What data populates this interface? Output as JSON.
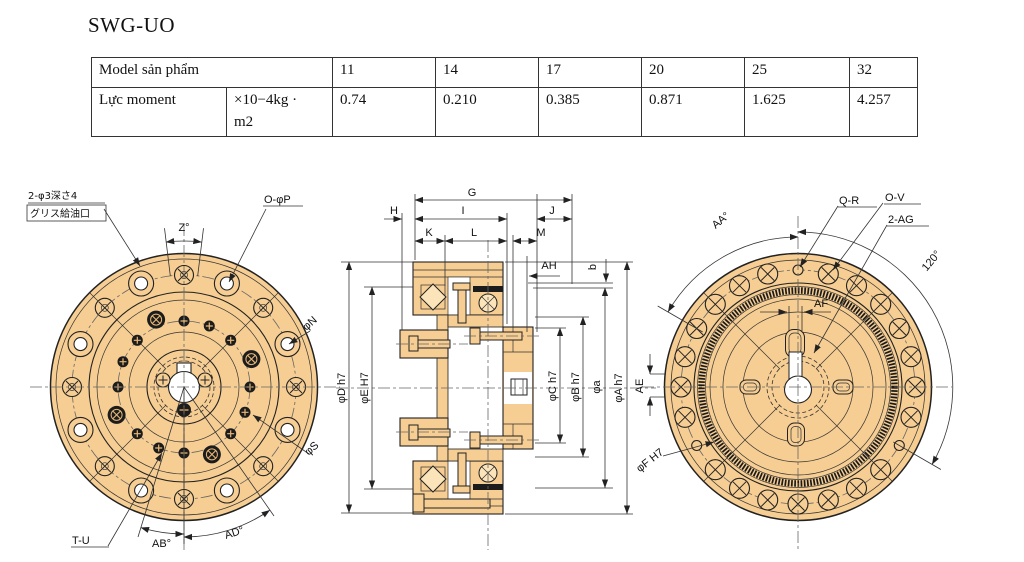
{
  "page": {
    "title": "SWG-UO"
  },
  "table": {
    "header_label": "Model sản phẩm",
    "models": [
      "11",
      "14",
      "17",
      "20",
      "25",
      "32"
    ],
    "row_label": "Lực moment",
    "unit_line1": "×10−4kg ·",
    "unit_line2": "m2",
    "values": [
      "0.74",
      "0.210",
      "0.385",
      "0.871",
      "1.625",
      "4.257"
    ]
  },
  "drawings": {
    "front_view": {
      "grease_note_line1": "2-φ3深さ4",
      "grease_note_line2": "グリス給油口",
      "bolt_label": "O-φP",
      "angle_z": "Z°",
      "dia_n": "φN",
      "dia_s": "φS",
      "screw_label": "T-U",
      "angle_ab": "AB°",
      "angle_ad": "AD°"
    },
    "section_view": {
      "dim_g": "G",
      "dim_h": "H",
      "dim_i": "I",
      "dim_j": "J",
      "dim_k": "K",
      "dim_l": "L",
      "dim_m": "M",
      "dim_ah": "AH",
      "dim_b": "b",
      "dia_d": "φD h7",
      "dia_e": "φE H7",
      "dia_c": "φC h7",
      "dia_b2": "φB h7",
      "dia_a_small": "φa",
      "dia_a": "φA h7",
      "dim_ae": "AE"
    },
    "back_view": {
      "angle_aa": "AA°",
      "hole_qr": "Q-R",
      "hole_ov": "O-V",
      "hole_ag": "2-AG",
      "angle_120": "120°",
      "dim_af": "AF",
      "dia_f": "φF H7"
    }
  },
  "colors": {
    "body_fill": "#f6cd92",
    "outline": "#222222",
    "centerline": "#666666"
  }
}
